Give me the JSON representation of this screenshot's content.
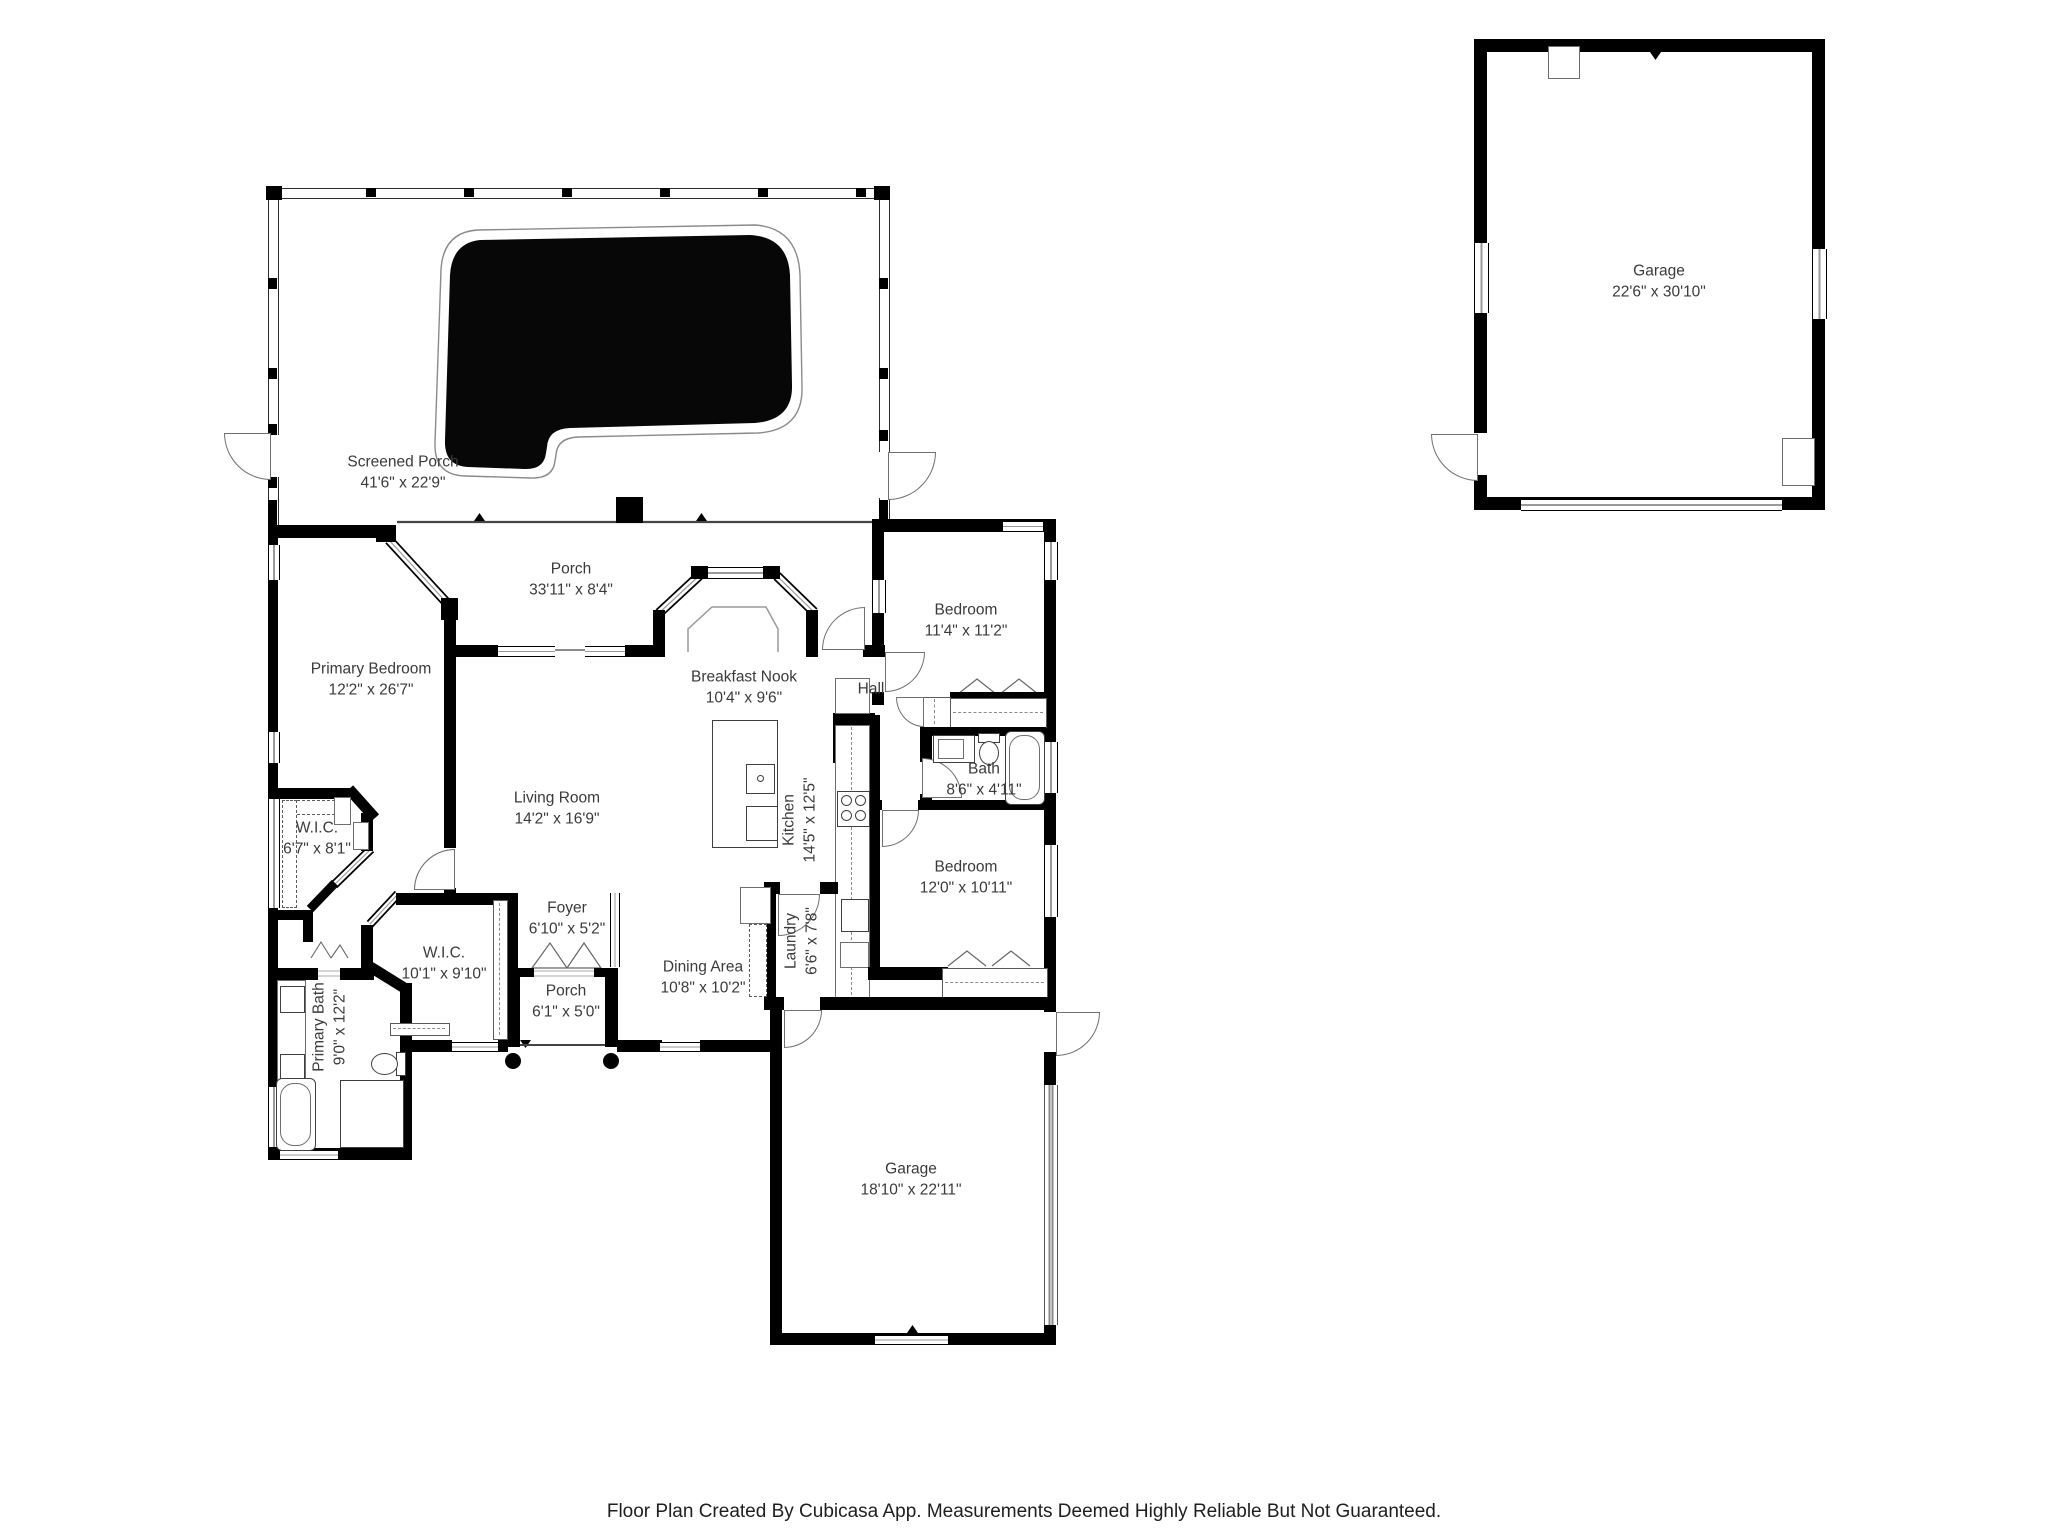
{
  "fp": {
    "rooms": {
      "screened_porch": {
        "name": "Screened Porch",
        "dims": "41'6\" x 22'9\""
      },
      "garage_detached": {
        "name": "Garage",
        "dims": "22'6\" x 30'10\""
      },
      "porch_back": {
        "name": "Porch",
        "dims": "33'11\" x 8'4\""
      },
      "primary_bedroom": {
        "name": "Primary Bedroom",
        "dims": "12'2\" x 26'7\""
      },
      "breakfast_nook": {
        "name": "Breakfast Nook",
        "dims": "10'4\" x 9'6\""
      },
      "bedroom_front": {
        "name": "Bedroom",
        "dims": "11'4\" x 11'2\""
      },
      "hall": {
        "name": "Hall",
        "dims": ""
      },
      "bath": {
        "name": "Bath",
        "dims": "8'6\" x 4'11\""
      },
      "living_room": {
        "name": "Living Room",
        "dims": "14'2\" x 16'9\""
      },
      "kitchen": {
        "name": "Kitchen",
        "dims": "14'5\" x 12'5\""
      },
      "bedroom_mid": {
        "name": "Bedroom",
        "dims": "12'0\" x 10'11\""
      },
      "wic_small": {
        "name": "W.I.C.",
        "dims": "6'7\" x 8'1\""
      },
      "wic_large": {
        "name": "W.I.C.",
        "dims": "10'1\" x 9'10\""
      },
      "primary_bath": {
        "name": "Primary Bath",
        "dims": "9'0\" x 12'2\""
      },
      "foyer": {
        "name": "Foyer",
        "dims": "6'10\" x 5'2\""
      },
      "porch_entry": {
        "name": "Porch",
        "dims": "6'1\" x 5'0\""
      },
      "dining_area": {
        "name": "Dining Area",
        "dims": "10'8\" x 10'2\""
      },
      "laundry": {
        "name": "Laundry",
        "dims": "6'6\" x 7'8\""
      },
      "garage_attached": {
        "name": "Garage",
        "dims": "18'10\" x 22'11\""
      }
    },
    "footer": "Floor Plan Created By Cubicasa App. Measurements Deemed Highly Reliable But Not Guaranteed.",
    "colors": {
      "wall": "#000000",
      "label_text": "#3a3a3a",
      "thin_line": "#8a8a8a",
      "pool": "#070707"
    }
  }
}
